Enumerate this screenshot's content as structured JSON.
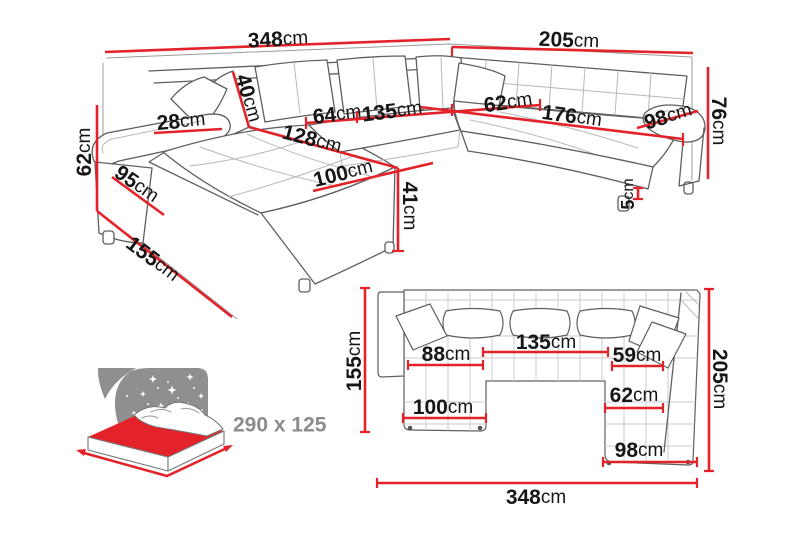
{
  "title": "Corner sofa-bed dimensions diagram",
  "colors": {
    "dimension_red": "#e32329",
    "sketch_outline": "#5f5f5f",
    "wall_gray": "#9b9b9b",
    "label_black": "#161616",
    "bed_icon_gray": "#8f8f8f",
    "sleeping_label_gray": "#8c8c8c"
  },
  "perspective_view": {
    "dims": {
      "w348": {
        "v": "348",
        "u": "cm"
      },
      "w205": {
        "v": "205",
        "u": "cm"
      },
      "h76": {
        "v": "76",
        "u": "cm"
      },
      "h62": {
        "v": "62",
        "u": "cm"
      },
      "p40": {
        "v": "40",
        "u": "cm"
      },
      "a28": {
        "v": "28",
        "u": "cm"
      },
      "s64": {
        "v": "64",
        "u": "cm"
      },
      "s135": {
        "v": "135",
        "u": "cm"
      },
      "c128": {
        "v": "128",
        "u": "cm"
      },
      "s62": {
        "v": "62",
        "u": "cm"
      },
      "s176": {
        "v": "176",
        "u": "cm"
      },
      "a98": {
        "v": "98",
        "u": "cm"
      },
      "h95": {
        "v": "95",
        "u": "cm"
      },
      "c100": {
        "v": "100",
        "u": "cm"
      },
      "h41": {
        "v": "41",
        "u": "cm"
      },
      "leg5": {
        "v": "5",
        "u": "cm"
      },
      "d155": {
        "v": "155",
        "u": "cm"
      }
    }
  },
  "plan_view": {
    "dims": {
      "d155": {
        "v": "155",
        "u": "cm"
      },
      "d205": {
        "v": "205",
        "u": "cm"
      },
      "w348": {
        "v": "348",
        "u": "cm"
      },
      "s135": {
        "v": "135",
        "u": "cm"
      },
      "s88": {
        "v": "88",
        "u": "cm"
      },
      "s59": {
        "v": "59",
        "u": "cm"
      },
      "s62": {
        "v": "62",
        "u": "cm"
      },
      "c100": {
        "v": "100",
        "u": "cm"
      },
      "r98": {
        "v": "98",
        "u": "cm"
      }
    }
  },
  "sleeping_area": {
    "label": "290 x 125"
  }
}
